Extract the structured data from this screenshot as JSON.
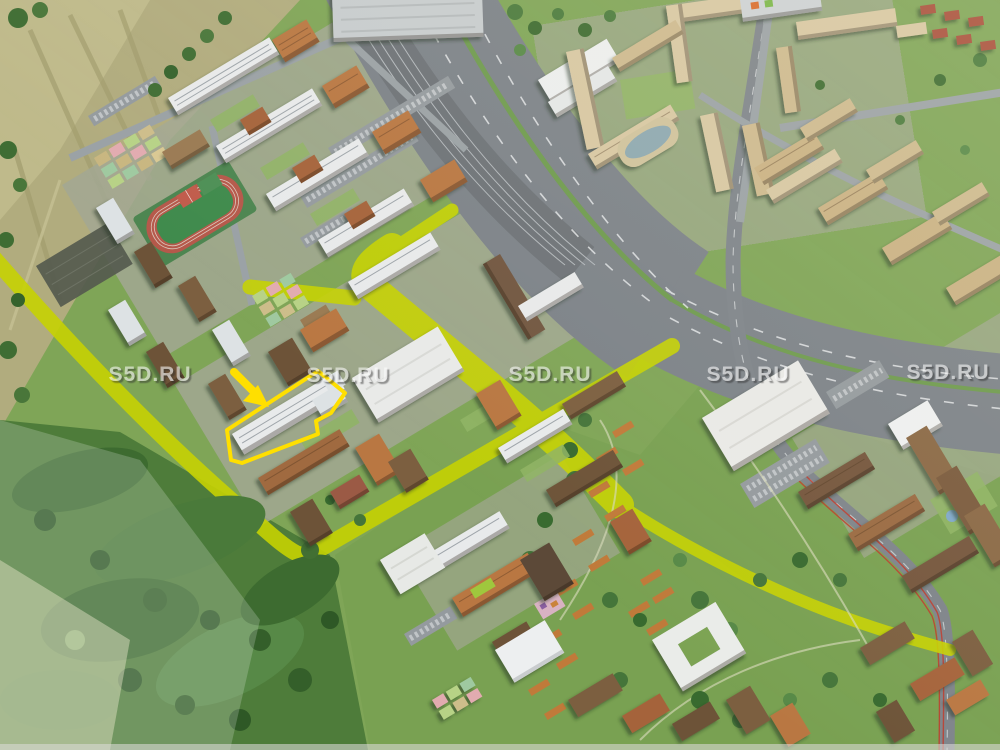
{
  "scene": {
    "type": "3d-aerial-masterplan-render",
    "areas": [
      "fields",
      "forest",
      "park",
      "highway-with-railway",
      "west-residential-district",
      "northeast-residential-district",
      "school-stadium",
      "kindergarten-plots",
      "retail-building",
      "highlighted-building",
      "pedestrian-route"
    ]
  },
  "watermark": {
    "text": "S5D.RU",
    "color": "#ffffff",
    "count": 5
  },
  "colors": {
    "highlight": "#ffdf00",
    "route": "#c6d203"
  }
}
